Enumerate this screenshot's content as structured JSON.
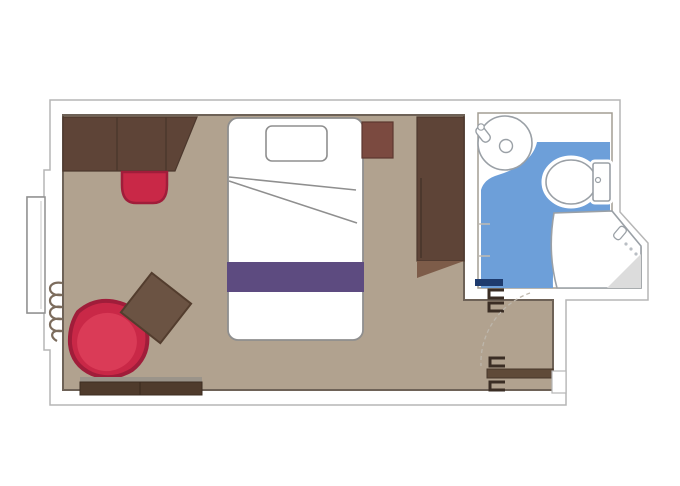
{
  "plan": {
    "type": "floor-plan",
    "areas": [
      "main-cabin",
      "bathroom",
      "entry-corridor",
      "balcony-window"
    ],
    "furniture": [
      "desk-unit",
      "desk-chair",
      "bed",
      "pillow",
      "bed-runner",
      "nightstand",
      "wardrobe",
      "armchair",
      "side-table",
      "bench",
      "sink",
      "toilet",
      "shower",
      "entry-door",
      "bathroom-door",
      "curtain-coil",
      "window"
    ]
  },
  "colors": {
    "page_bg": "#ffffff",
    "wall_fill": "#ffffff",
    "wall_edge_outer": "#b6b6b6",
    "wall_edge_inner": "#6e6257",
    "floor": "#b1a28f",
    "bath_floor": "#6d9fd9",
    "bath_wall_edge": "#a39d94",
    "fixture_fill": "#ffffff",
    "fixture_outline": "#9aa0a6",
    "shower_shade": "#dcdcdc",
    "wood_dark": "#5e4437",
    "wood_dark_edge": "#4c382d",
    "wood_light": "#7d5c49",
    "nightstand": "#7b4a40",
    "nightstand_edge": "#5d372f",
    "seat_red": "#c92847",
    "seat_red_edge": "#a01d3a",
    "seat_red_light": "#da3b57",
    "runner_purple": "#5d4b80",
    "table_wood": "#6b5343",
    "table_wood_edge": "#533d2e",
    "bench_top": "#9b948a",
    "bench_body": "#4f3b2c",
    "bench_edge": "#3c2c20",
    "door_navy": "#1e3b6e",
    "door_wood": "#5f4a38",
    "door_wood_edge": "#46362a",
    "door_bracket": "#3a2d24",
    "swing_arc": "#bdb6ab",
    "curtain": "#7c6c5d",
    "window_edge": "#8f8f8f",
    "bed_outline": "#8f8f8f"
  }
}
